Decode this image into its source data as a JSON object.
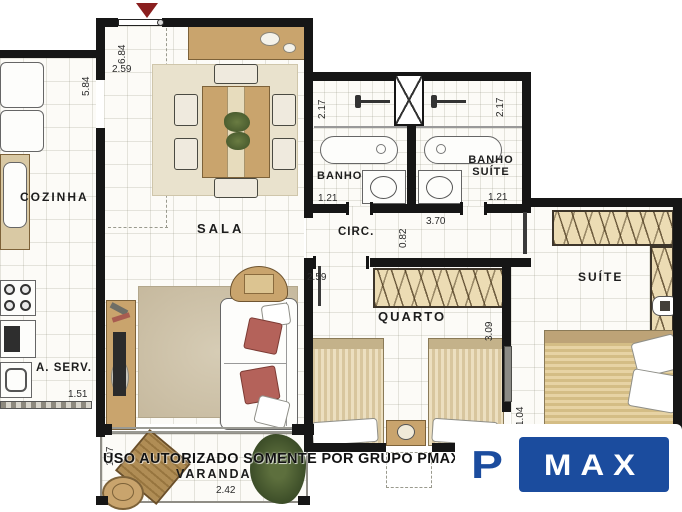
{
  "rooms": {
    "cozinha": "COZINHA",
    "sala": "SALA",
    "banho": "BANHO",
    "banho_suite_line1": "BANHO",
    "banho_suite_line2": "SUÍTE",
    "circ": "CIRC.",
    "suite": "SUÍTE",
    "quarto": "QUARTO",
    "area_servico": "A. SERV.",
    "varanda": "VARANDA"
  },
  "dimensions": {
    "entry_width": "2.59",
    "hall_depth": "6.84",
    "kitchen_length": "5.84",
    "banho_height": "2.17",
    "banho_suite_height": "2.17",
    "banho_width": "1.21",
    "banho_suite_width": "1.21",
    "circ_width": "0.82",
    "circ_length": "3.70",
    "quarto_width": "2.59",
    "quarto_depth": "3.09",
    "aserv_width": "1.51",
    "varanda_depth": "1.07",
    "varanda_width": "2.42",
    "door_width": "1.04"
  },
  "watermark": "USO AUTORIZADO SOMENTE POR GRUPO PMAX",
  "logo": {
    "p": "P",
    "max": "MAX"
  },
  "colors": {
    "wall": "#161616",
    "wood": "#c9a46d",
    "logo_blue": "#1b4c9e",
    "arrow_red": "#8a1f1f"
  }
}
